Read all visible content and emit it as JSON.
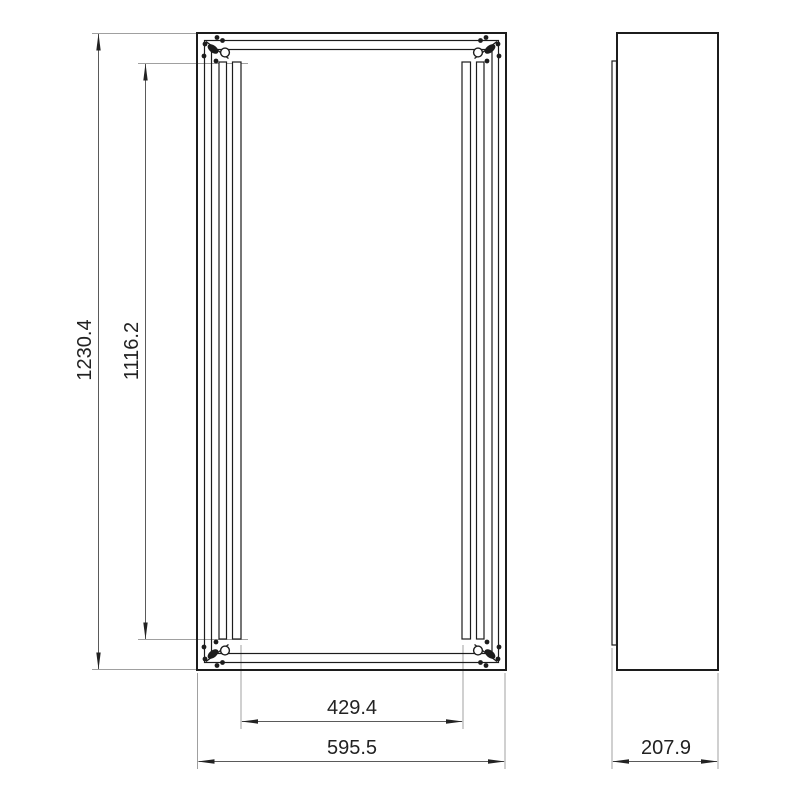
{
  "page": {
    "background": "#ffffff",
    "kind": "technical-dimension-drawing"
  },
  "drawing": {
    "views": [
      {
        "id": "front-view"
      },
      {
        "id": "side-view"
      }
    ],
    "dimensions": {
      "overall_height": {
        "value": "1230.4",
        "orientation": "vertical"
      },
      "rail_length": {
        "value": "1116.2",
        "orientation": "vertical"
      },
      "rail_inner_spacing": {
        "value": "429.4",
        "orientation": "horizontal"
      },
      "overall_width": {
        "value": "595.5",
        "orientation": "horizontal"
      },
      "overall_depth": {
        "value": "207.9",
        "orientation": "horizontal"
      }
    },
    "colors": {
      "geometry_line": "#1c1c1c",
      "dimension_line": "#5a5a5a",
      "extension_line": "#a0a0a0",
      "dimension_text": "#222222"
    }
  }
}
